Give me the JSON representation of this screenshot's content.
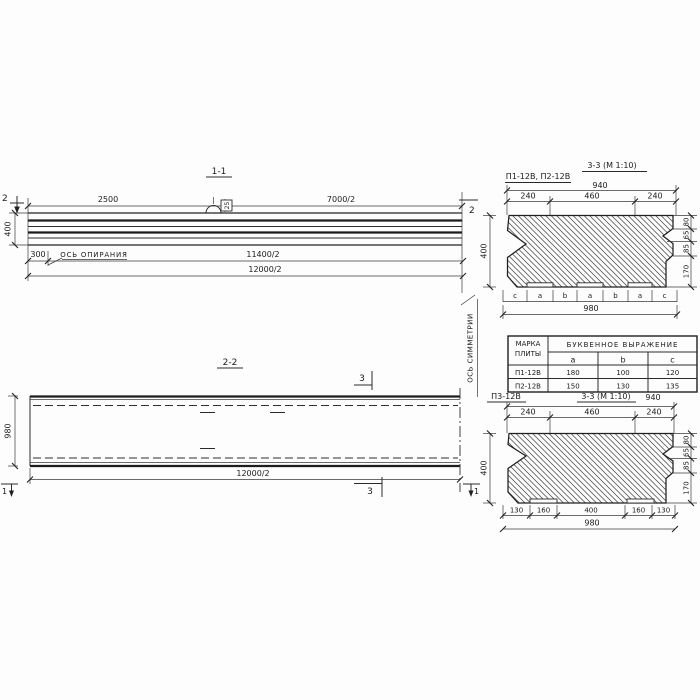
{
  "drawing": {
    "section11": {
      "title": "1-1",
      "cut_marker": "2",
      "dim_2500": "2500",
      "dim_7000": "7000/2",
      "dim_400": "400",
      "dim_300": "300",
      "dim_11400": "11400/2",
      "dim_12000": "12000/2",
      "support_axis_label": "ОСЬ ОПИРАНИЯ",
      "loop_label": "25"
    },
    "section22": {
      "title": "2-2",
      "cut_marker_3": "3",
      "cut_marker_1": "1",
      "dim_980": "980",
      "dim_12000": "12000/2",
      "symmetry_axis_label": "ОСЬ СИММЕТРИИ"
    },
    "section33top": {
      "plate_label": "П1-12В, П2-12В",
      "title": "3-3 (М 1:10)",
      "dim_940": "940",
      "dims_top": [
        "240",
        "460",
        "240"
      ],
      "dim_400": "400",
      "dims_right": [
        "80",
        "65",
        "85",
        "170"
      ],
      "letter_row": [
        "c",
        "a",
        "b",
        "a",
        "b",
        "a",
        "c"
      ],
      "dim_980": "980"
    },
    "table": {
      "col1_header_line1": "МАРКА",
      "col1_header_line2": "ПЛИТЫ",
      "col2_header": "БУКВЕННОЕ ВЫРАЖЕНИЕ",
      "sub_headers": [
        "a",
        "b",
        "c"
      ],
      "rows": [
        {
          "mark": "П1-12В",
          "a": "180",
          "b": "100",
          "c": "120"
        },
        {
          "mark": "П2-12В",
          "a": "150",
          "b": "130",
          "c": "135"
        }
      ]
    },
    "section33bottom": {
      "plate_label": "П3-12В",
      "title": "3-3 (М 1:10)",
      "dim_940": "940",
      "dims_top": [
        "240",
        "460",
        "240"
      ],
      "dim_400": "400",
      "dims_right": [
        "80",
        "65",
        "85",
        "170"
      ],
      "dims_bottom": [
        "130",
        "160",
        "400",
        "160",
        "130"
      ],
      "dim_980": "980"
    }
  }
}
